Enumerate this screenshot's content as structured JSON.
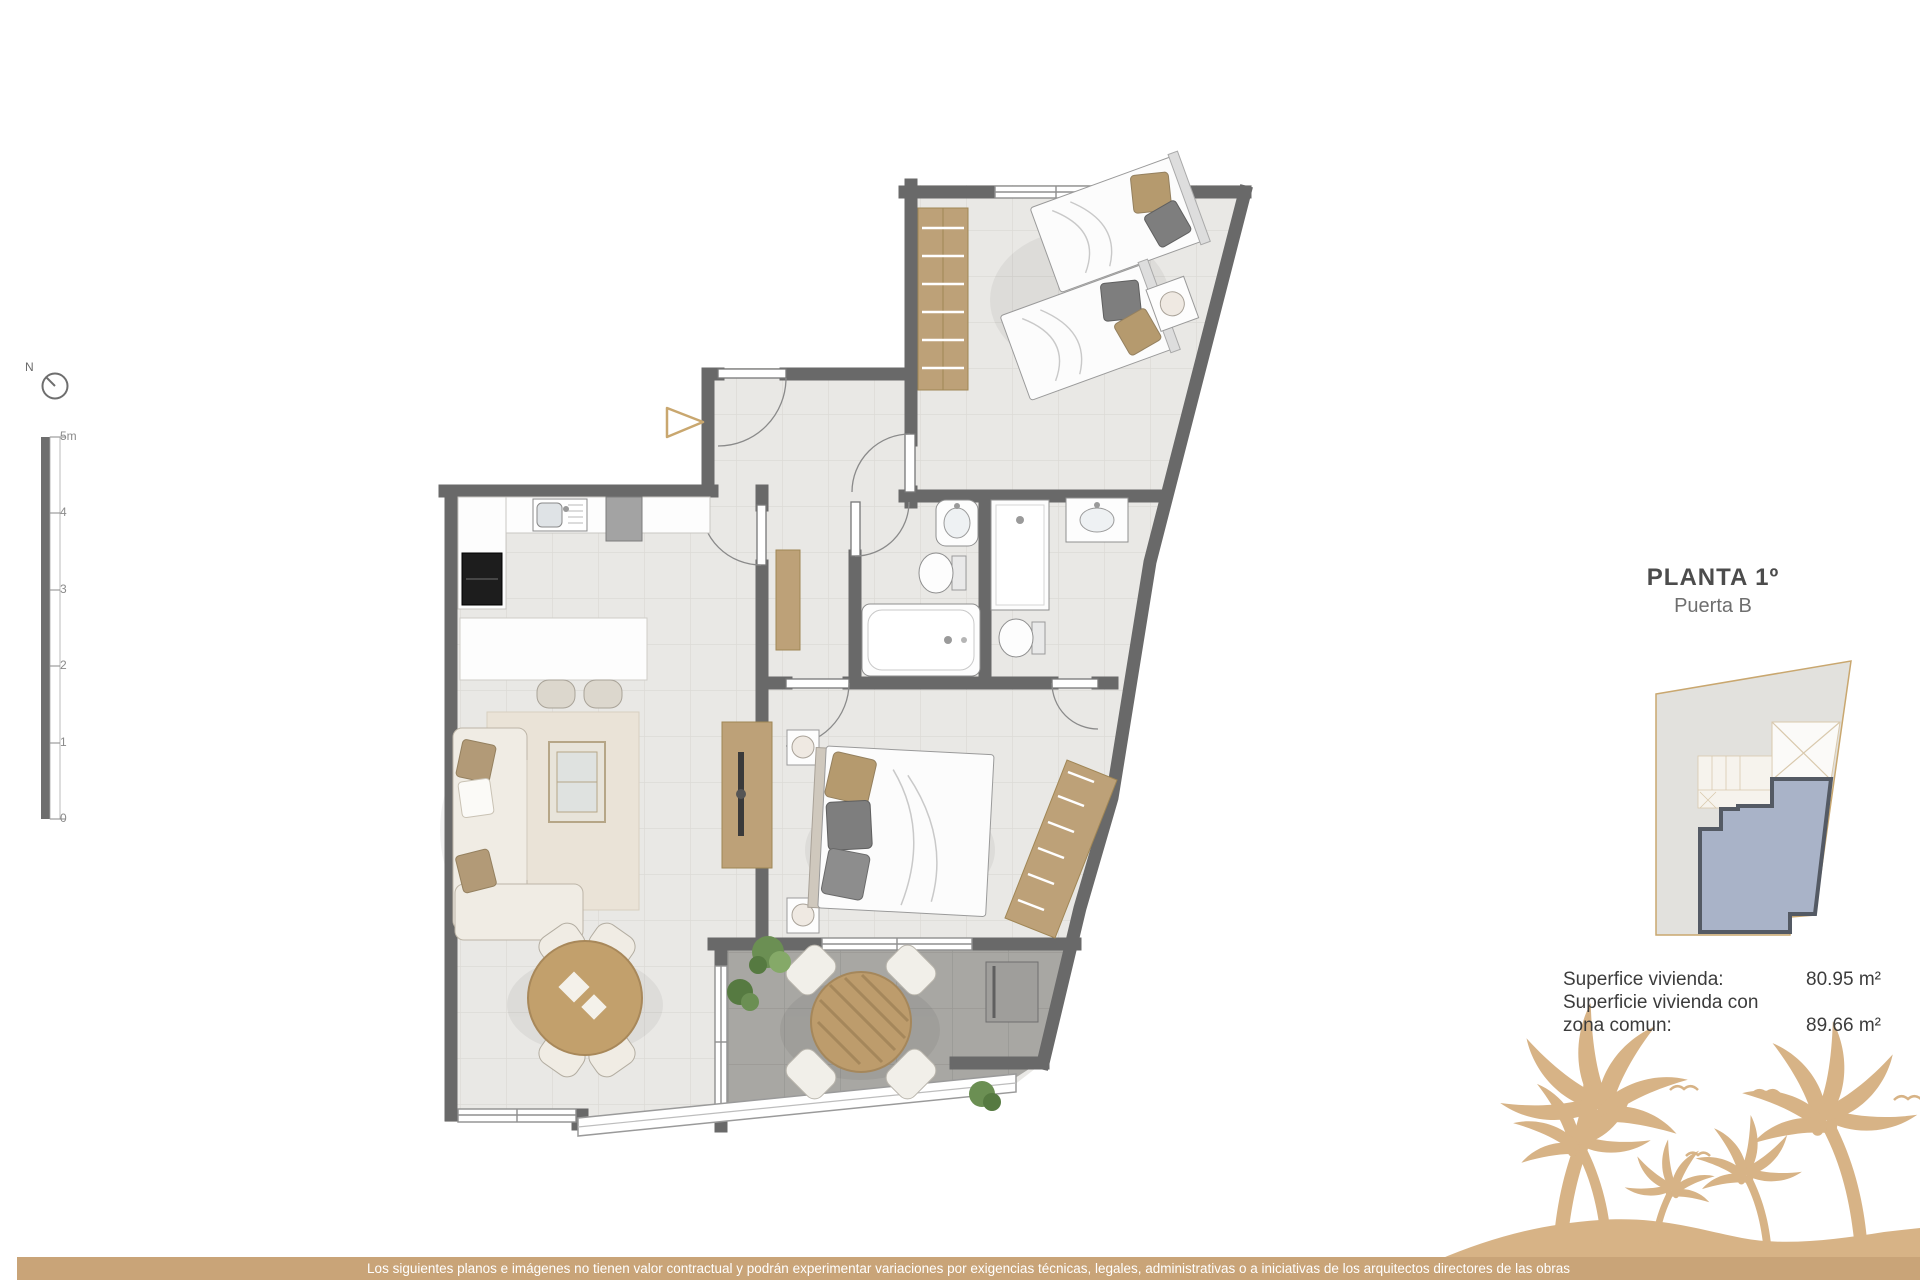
{
  "plan": {
    "north_label": "N",
    "scale_labels": [
      "5m",
      "4",
      "3",
      "2",
      "1",
      "0"
    ]
  },
  "info_panel": {
    "title": "PLANTA 1º",
    "subtitle": "Puerta B",
    "area_rows": [
      {
        "label": "Superfice vivienda:",
        "value": "80.95 m²"
      },
      {
        "label": "Superficie vivienda con",
        "value": ""
      },
      {
        "label": "zona comun:",
        "value": "89.66 m²"
      }
    ]
  },
  "footer": {
    "disclaimer": "Los siguientes planos e imágenes no tienen valor contractual y podrán experimentar variaciones por exigencias técnicas, legales, administrativas o a iniciativas de los arquitectos directores de las obras"
  },
  "colors": {
    "wall_gray": "#696969",
    "accent_tan": "#c9a478",
    "palm_tan": "#d7b386",
    "wood": "#bda178",
    "unit_highlight_blue": "#a9b3c8",
    "floor_tile": "#e9e8e5",
    "terrace_tile": "#a8a7a3"
  }
}
